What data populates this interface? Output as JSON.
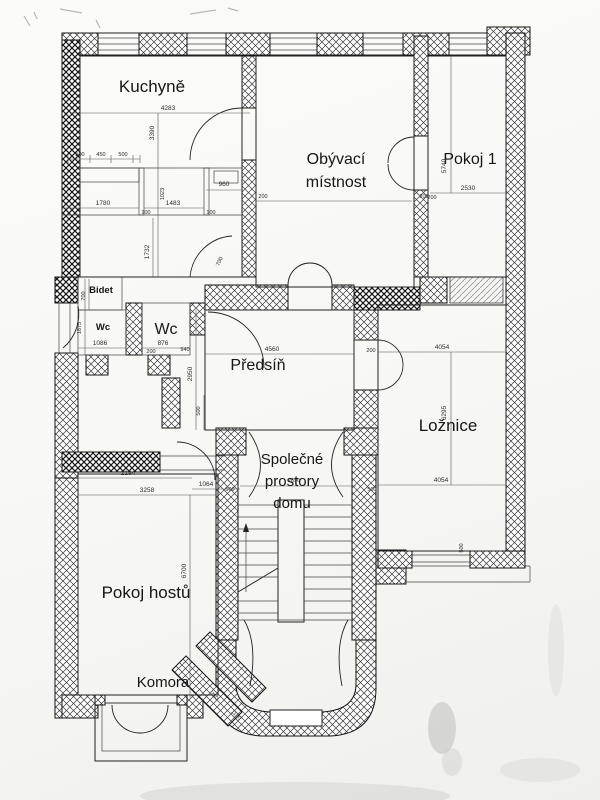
{
  "plan": {
    "rooms": {
      "kuchyne": "Kuchyně",
      "obyvaci_line1": "Obývací",
      "obyvaci_line2": "místnost",
      "pokoj1": "Pokoj 1",
      "bidet": "Bidet",
      "wc_small": "Wc",
      "wc_large": "Wc",
      "predsin": "Předsíň",
      "loznice": "Ložnice",
      "spolecne_line1": "Společné",
      "spolecne_line2": "prostory",
      "spolecne_line3": "domu",
      "pokoj_hostu": "Pokoj hostů",
      "komora": "Komora"
    },
    "dims": {
      "kuchyne_w": "4283",
      "kuchyne_h": "3390",
      "k_500a": "500",
      "k_450": "450",
      "k_500b": "500",
      "k_1780": "1780",
      "k_1483": "1483",
      "k_100a": "100",
      "k_100b": "100",
      "k_960": "960",
      "k_1023": "1023",
      "k_1732": "1732",
      "bidet_700": "700",
      "door_700": "700",
      "wc_1086": "1086",
      "wc_1875": "1875",
      "wc_876": "876",
      "wc_200": "200",
      "wc_940": "940",
      "hall_4560": "4560",
      "hall_2950": "2950",
      "hall_500": "500",
      "hall_200": "200",
      "living_200l": "200",
      "living_200r": "200",
      "pokoj1_2530": "2530",
      "pokoj1_5740": "5740",
      "pokoj1_200": "200",
      "bed_4054_top": "4054",
      "bed_6295": "6295",
      "bed_4054_bottom": "4054",
      "bed_500a": "500",
      "bed_500b": "500",
      "common_2696": "2696",
      "common_500l": "500",
      "guest_2194": "2194",
      "guest_3258": "3258",
      "guest_1064": "1064",
      "guest_6700": "6700",
      "komora_750": "750",
      "komora_1150": "1150"
    }
  }
}
